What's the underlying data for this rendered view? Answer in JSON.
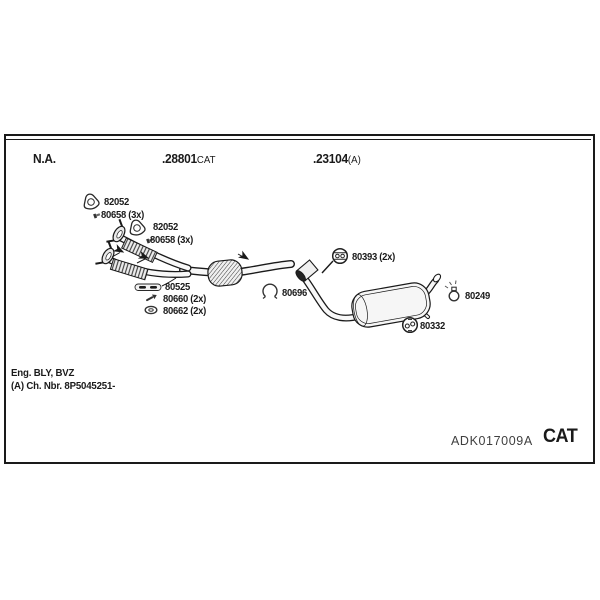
{
  "header": {
    "na": "N.A.",
    "mid": {
      "code": ".28801",
      "suffix": "CAT"
    },
    "right": {
      "code": ".23104",
      "suffix": "(A)"
    }
  },
  "parts": [
    {
      "label": "82052",
      "icon": "gasket-icon"
    },
    {
      "label": "80658 (3x)",
      "icon": "stud-bolt-icon"
    },
    {
      "label": "82052",
      "icon": "gasket-icon"
    },
    {
      "label": "80658 (3x)",
      "icon": "stud-bolt-icon"
    },
    {
      "label": "80525",
      "icon": "mounting-bracket-icon"
    },
    {
      "label": "80660 (2x)",
      "icon": "screw-icon"
    },
    {
      "label": "80662 (2x)",
      "icon": "washer-nut-icon"
    },
    {
      "label": "80696",
      "icon": "pipe-clamp-icon"
    },
    {
      "label": "80393 (2x)",
      "icon": "rubber-hanger-icon"
    },
    {
      "label": "80249",
      "icon": "bolt-clamp-icon"
    },
    {
      "label": "80332",
      "icon": "rubber-hanger-icon"
    }
  ],
  "footer": {
    "engine": "Eng. BLY, BVZ",
    "chassis": "(A) Ch. Nbr. 8P5045251-"
  },
  "stamp": {
    "reference": "ADK017009A",
    "type": "CAT"
  },
  "colors": {
    "ink": "#1a1a1a",
    "paper": "#ffffff",
    "stamp_ref": "#3f3f3f"
  }
}
